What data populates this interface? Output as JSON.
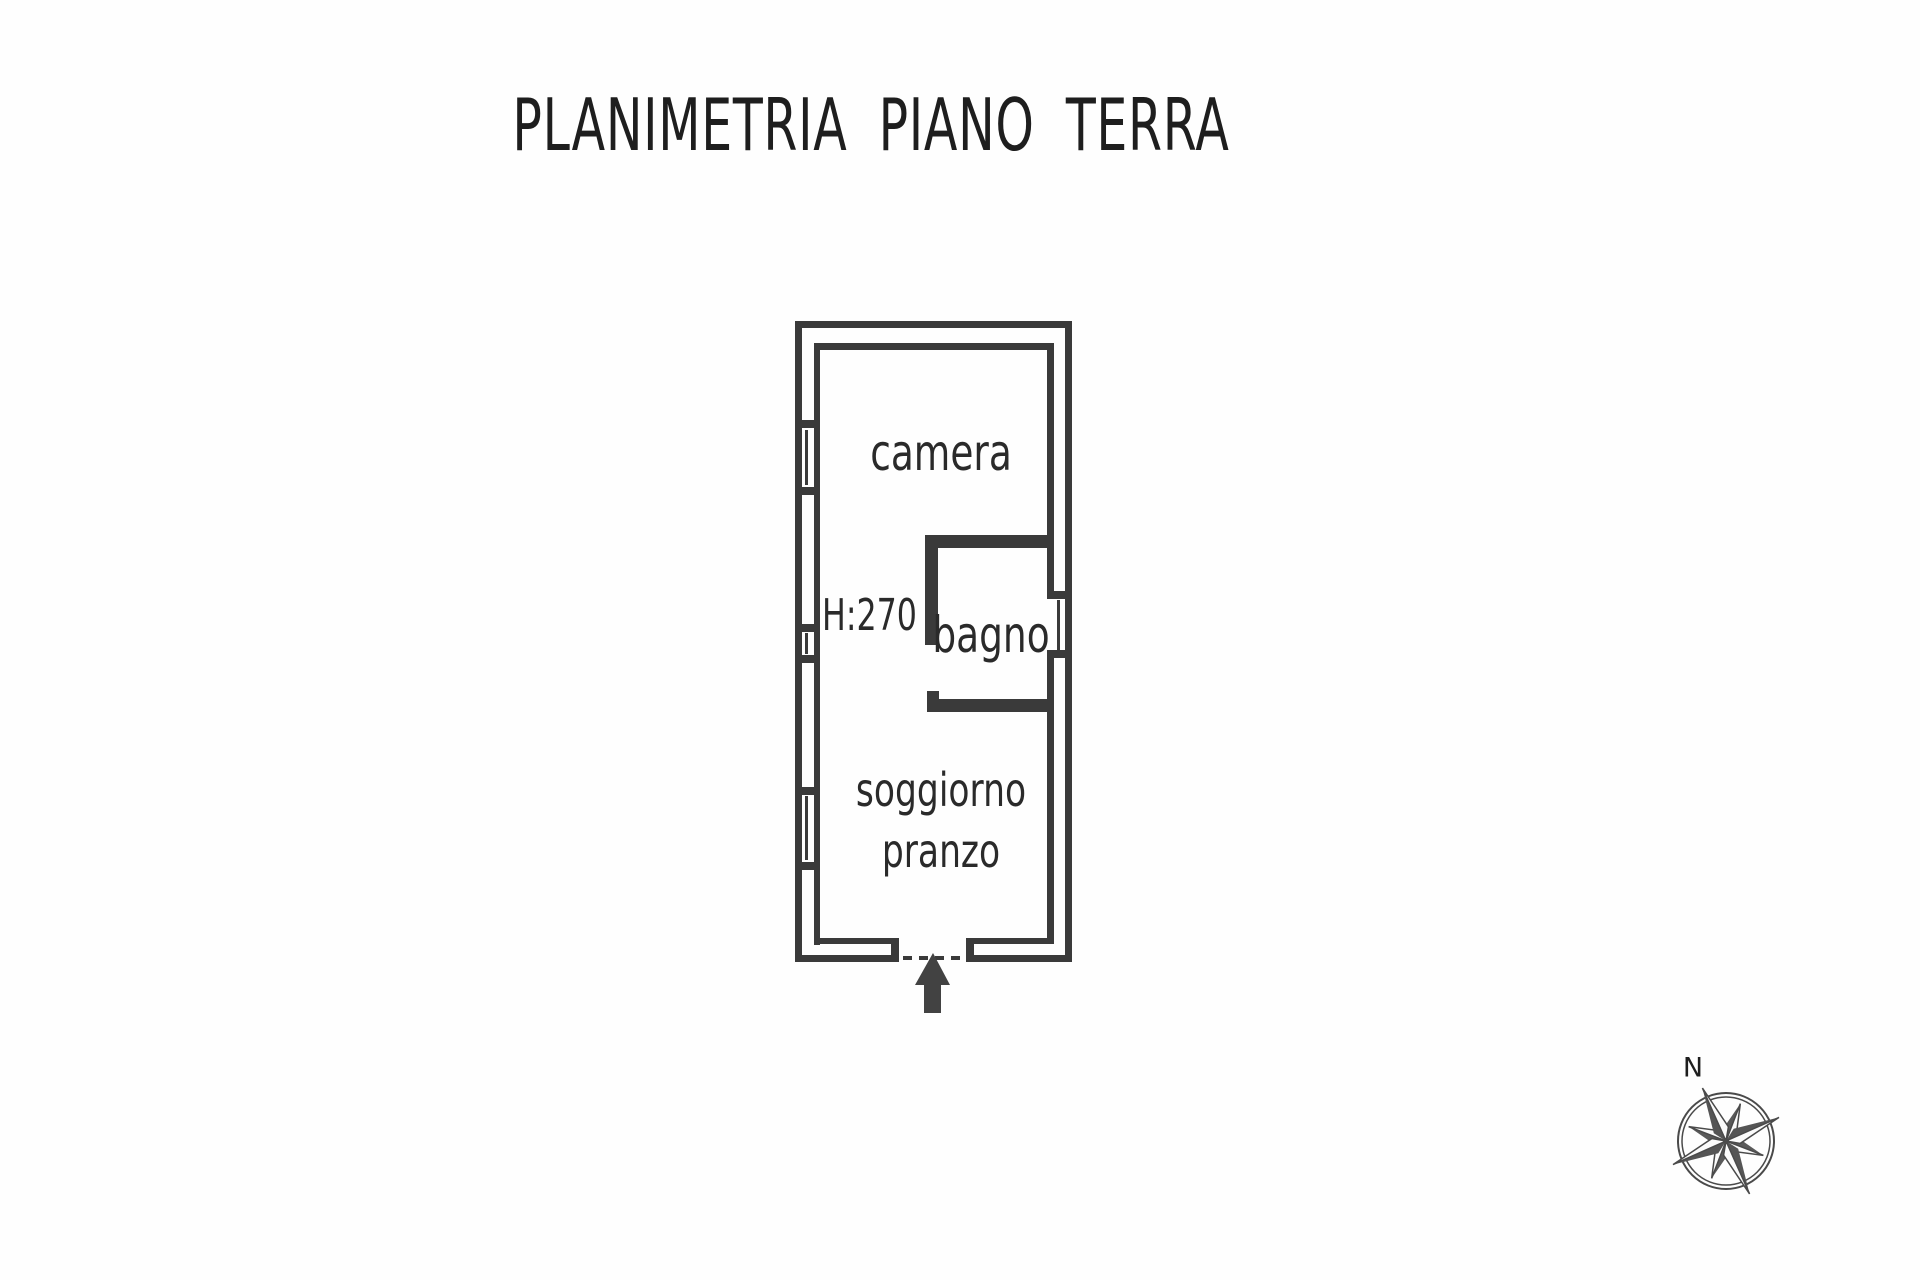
{
  "title": "PLANIMETRIA PIANO TERRA",
  "plan": {
    "room_camera": "camera",
    "room_bagno": "bagno",
    "room_soggiorno_line1": "soggiorno",
    "room_soggiorno_line2": "pranzo",
    "height_label": "H:270",
    "compass_north": "N"
  },
  "colors": {
    "ink": "#3a3a3a",
    "text": "#2a2a2a",
    "background": "#fefefe",
    "arrow": "#424242",
    "compass_stroke": "#4a4a4a"
  }
}
